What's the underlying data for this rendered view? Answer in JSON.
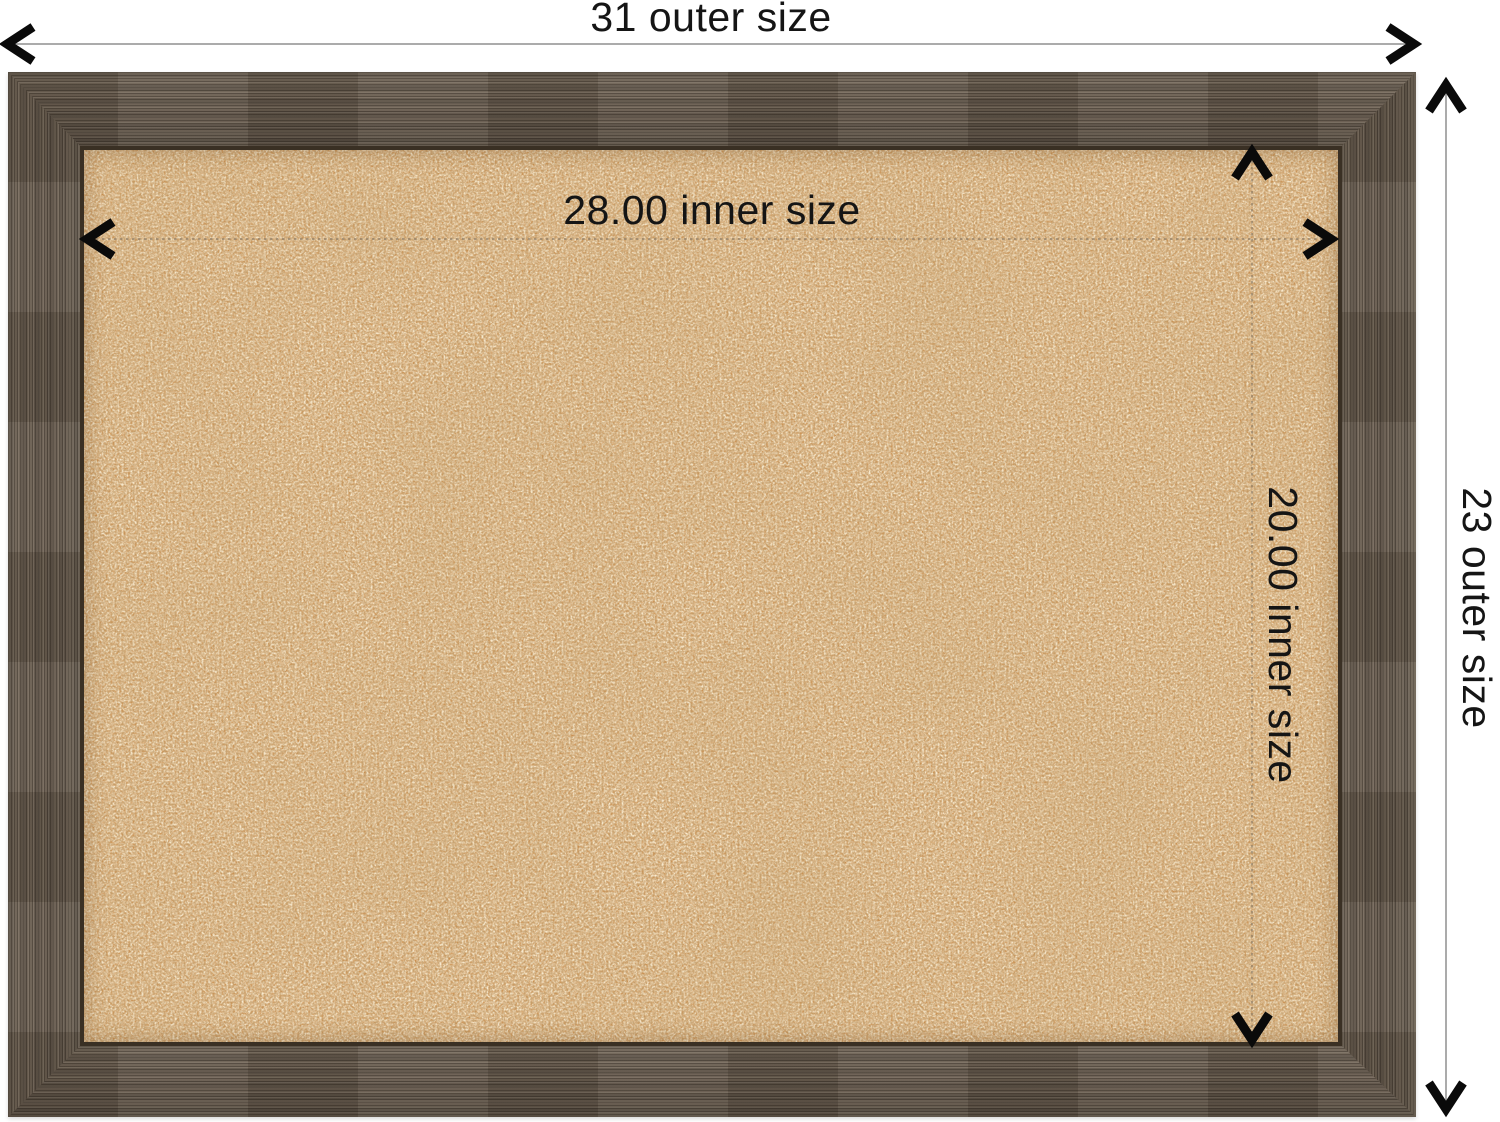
{
  "annotations": {
    "outer_width": {
      "label": "31 outer size",
      "value": 31
    },
    "outer_height": {
      "label": "23 outer size",
      "value": 23
    },
    "inner_width": {
      "label": "28.00 inner size",
      "value": 28.0
    },
    "inner_height": {
      "label": "20.00 inner size",
      "value": 20.0
    }
  },
  "icons": {
    "arrowhead_style": "black chevron arrowhead",
    "arrow_left": "chevron-left",
    "arrow_right": "chevron-right",
    "arrow_up": "chevron-up",
    "arrow_down": "chevron-down"
  },
  "colors": {
    "background": "#ffffff",
    "text": "#151515",
    "outer_dimension_line": "#ababab",
    "inner_dimension_line": "#8b7a64",
    "arrowhead": "#0a0a0a",
    "frame_wood": "#665a4d",
    "frame_wood_dark": "#4c4236",
    "frame_wood_light": "#7e7163",
    "frame_inner_lip": "#3a3024",
    "cork_base": "#c98e4e",
    "cork_light_speckle": "#f2d3a0",
    "cork_dark_speckle": "#8a5a28"
  }
}
